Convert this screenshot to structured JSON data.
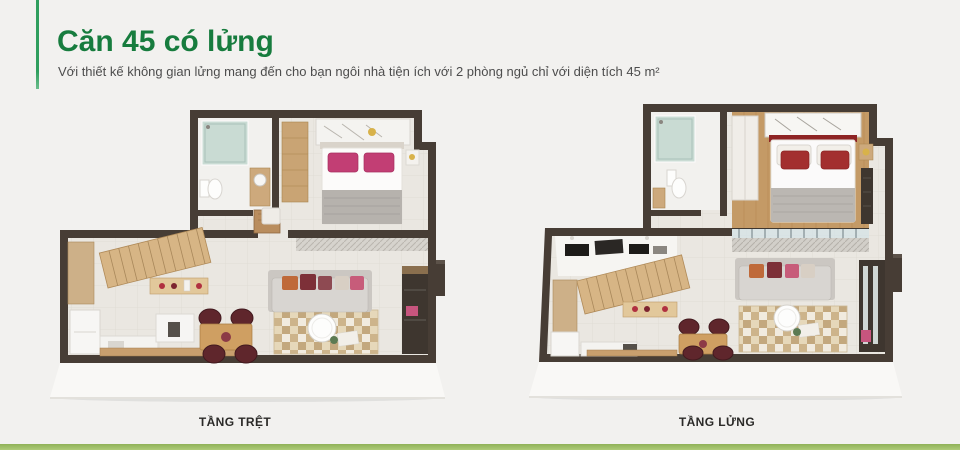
{
  "header": {
    "title": "Căn 45 có lửng",
    "subtitle": "Với thiết kế không gian lửng mang đến cho bạn ngôi nhà tiện ích với 2 phòng ngủ chỉ với diện tích 45 m²"
  },
  "plans": [
    {
      "label": "TẦNG TRỆT",
      "name": "ground-floor-plan"
    },
    {
      "label": "TẦNG LỬNG",
      "name": "mezzanine-floor-plan"
    }
  ],
  "colors": {
    "accent-green": "#177c3e",
    "accent-bar-green": "#2f9e5d",
    "footer-green": "#aecb79",
    "background": "#f2f1ef",
    "subtitle-text": "#4d4d4d",
    "label-text": "#2b2a28",
    "wall-dark": "#473d35",
    "floor-light": "#eae7e1",
    "wood": "#d0ab79",
    "pillow-magenta": "#c23e74",
    "pillow-red": "#a32f2f"
  }
}
